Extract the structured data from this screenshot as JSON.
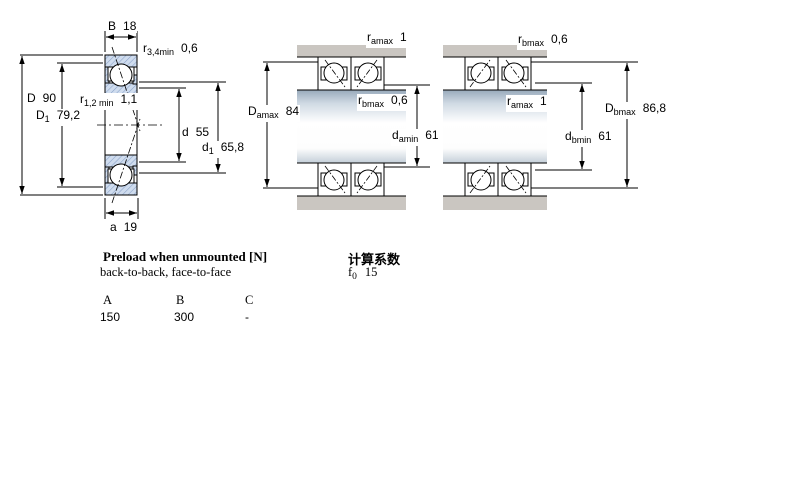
{
  "drawing_left": {
    "dims": {
      "B": {
        "sym": "B",
        "value": "18"
      },
      "r34": {
        "sym": "r",
        "sub": "3,4min",
        "value": "0,6"
      },
      "D": {
        "sym": "D",
        "value": "90"
      },
      "D1": {
        "sym": "D",
        "sub": "1",
        "value": "79,2"
      },
      "r12": {
        "sym": "r",
        "sub": "1,2 min",
        "value": "1,1"
      },
      "d": {
        "sym": "d",
        "value": "55"
      },
      "d1": {
        "sym": "d",
        "sub": "1",
        "value": "65,8"
      },
      "a": {
        "sym": "a",
        "value": "19"
      }
    }
  },
  "drawing_middle": {
    "dims": {
      "ramax": {
        "sym": "r",
        "sub": "amax",
        "value": "1"
      },
      "Damax": {
        "sym": "D",
        "sub": "amax",
        "value": "84"
      },
      "rbmax": {
        "sym": "r",
        "sub": "bmax",
        "value": "0,6"
      },
      "damin": {
        "sym": "d",
        "sub": "amin",
        "value": "61"
      }
    }
  },
  "drawing_right": {
    "dims": {
      "rbmax": {
        "sym": "r",
        "sub": "bmax",
        "value": "0,6"
      },
      "ramax": {
        "sym": "r",
        "sub": "amax",
        "value": "1"
      },
      "dbmin": {
        "sym": "d",
        "sub": "bmin",
        "value": "61"
      },
      "Dbmax": {
        "sym": "D",
        "sub": "bmax",
        "value": "86,8"
      }
    }
  },
  "preload_table": {
    "title": "Preload when unmounted [N]",
    "subtitle": "back-to-back, face-to-face",
    "columns": [
      "A",
      "B",
      "C"
    ],
    "rows": [
      [
        "150",
        "300",
        "-"
      ]
    ]
  },
  "calculation_factors": {
    "title": "计算系数",
    "factor": {
      "sym": "f",
      "sub": "0",
      "value": "15"
    }
  },
  "colors": {
    "ring_fill": "#cfdcee",
    "ring_hatch": "#8aa2c8",
    "housing_gray": "#cac6c1",
    "line": "#000000"
  }
}
